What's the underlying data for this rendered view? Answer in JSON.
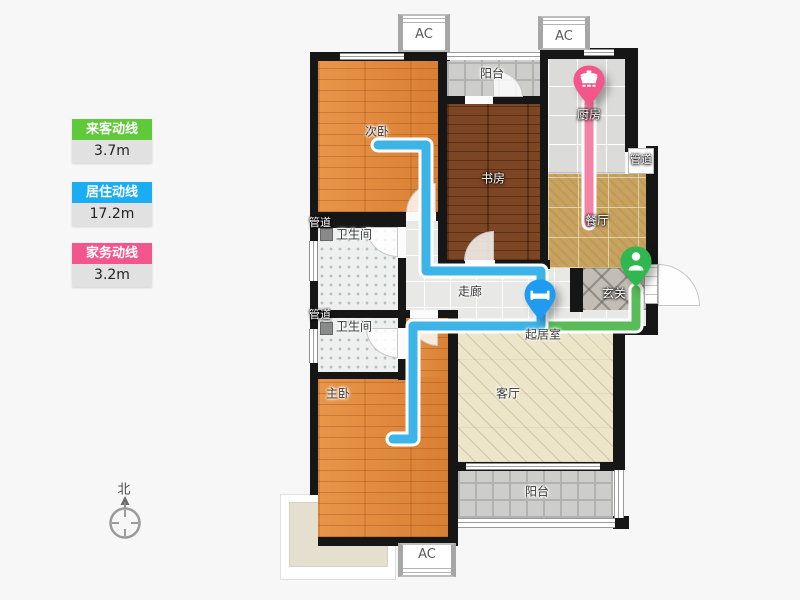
{
  "legend": {
    "items": [
      {
        "label": "来客动线",
        "value": "3.7m",
        "color": "#5fc93a"
      },
      {
        "label": "居住动线",
        "value": "17.2m",
        "color": "#1badf2"
      },
      {
        "label": "家务动线",
        "value": "3.2m",
        "color": "#f2568c"
      }
    ]
  },
  "compass": {
    "north_label": "北"
  },
  "rooms": {
    "balcony_top": {
      "label": "阳台"
    },
    "bedroom2": {
      "label": "次卧"
    },
    "study": {
      "label": "书房"
    },
    "kitchen": {
      "label": "厨房"
    },
    "dining": {
      "label": "餐厅"
    },
    "entry": {
      "label": "玄关"
    },
    "corridor": {
      "label": "走廊"
    },
    "bath1": {
      "label": "卫生间"
    },
    "bath2": {
      "label": "卫生间"
    },
    "living_area": {
      "label": "起居室"
    },
    "master": {
      "label": "主卧"
    },
    "living": {
      "label": "客厅"
    },
    "balcony_bottom": {
      "label": "阳台"
    }
  },
  "ducts": {
    "right": "管道",
    "bath1": "管道",
    "bath2": "管道"
  },
  "ac": {
    "top_left": "AC",
    "top_right": "AC",
    "bottom": "AC"
  },
  "paths": {
    "visitor": {
      "name": "来客动线",
      "length": "3.7m",
      "color": "#58bc58",
      "points": "636,290 636,326 542,326"
    },
    "resident": {
      "name": "居住动线",
      "length": "17.2m",
      "color": "#3cb4e8",
      "points": "378,145 426,145 426,271 541,271 541,326 413,326 413,439 393,439"
    },
    "chores": {
      "name": "家务动线",
      "length": "3.2m",
      "color": "#f282a6",
      "points": "589,103 589,223"
    }
  },
  "pins": {
    "living": {
      "icon": "bed-icon",
      "color": "#1f9bf0",
      "room": "起居室"
    },
    "entry": {
      "icon": "person-icon",
      "color": "#2eb84f",
      "room": "玄关"
    },
    "kitchen": {
      "icon": "pot-icon",
      "color": "#f2568a",
      "room": "厨房"
    }
  }
}
